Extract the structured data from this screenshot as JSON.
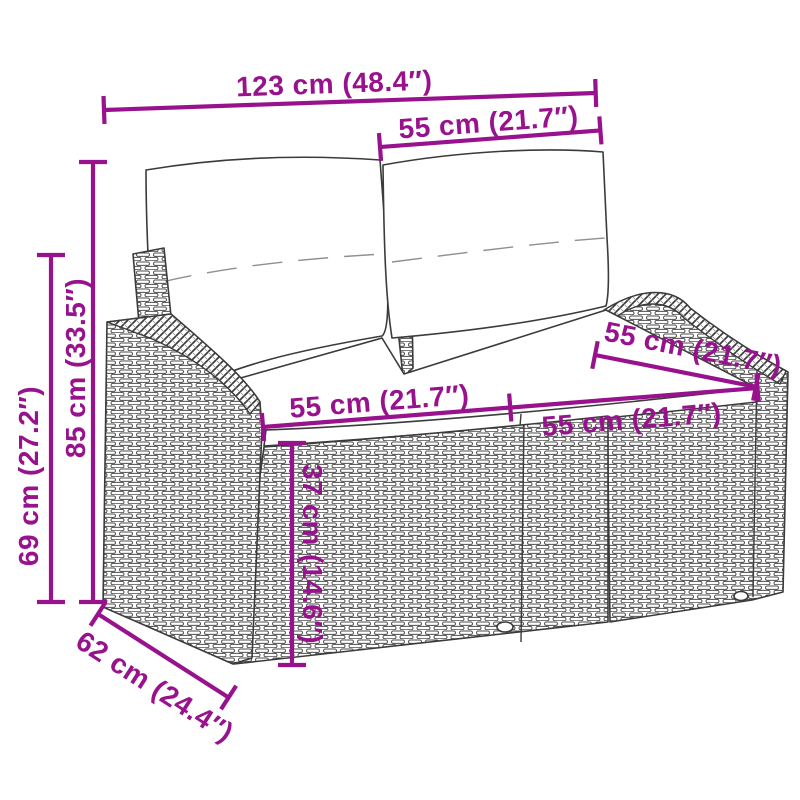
{
  "palette": {
    "background": "#ffffff",
    "dimension_accent": "#97128C",
    "line_art": "#3b3b3b",
    "wicker_stroke": "#4d4d4d"
  },
  "illustration": {
    "subject": "rattan-loveseat-with-cushions",
    "style": "grayscale-line-art"
  },
  "dimensions": {
    "overall_width": "123 cm (48.4″)",
    "backrest_section_width": "55 cm (21.7″)",
    "total_height": "85 cm (33.5″)",
    "armrest_height": "69 cm (27.2″)",
    "seat_width_left": "55 cm (21.7″)",
    "seat_width_right": "55 cm (21.7″)",
    "seat_depth": "55 cm (21.7″)",
    "seat_height": "37 cm (14.6″)",
    "overall_depth": "62 cm (24.4″)"
  }
}
